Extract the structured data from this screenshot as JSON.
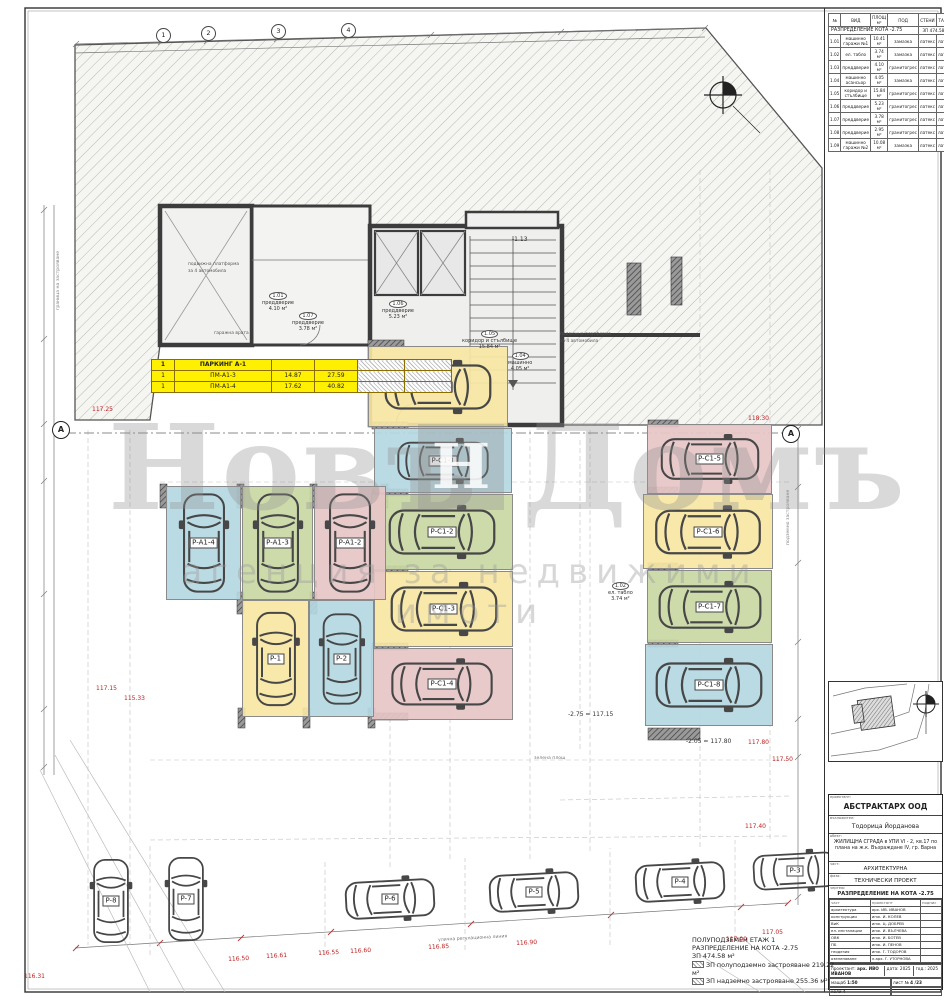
{
  "schedule": {
    "columns": [
      "№",
      "ВИД",
      "ПЛОЩ м²",
      "ПОД",
      "СТЕНИ",
      "ТАВАН"
    ],
    "title": "РАЗПРЕДЕЛЕНИЕ КОТА -2.75",
    "area_note": "ЗП 474.58 м²",
    "rows": [
      [
        "1.01",
        "машинно гаражи №1",
        "10.41 м²",
        "замазка",
        "латекс",
        "латекс"
      ],
      [
        "1.02",
        "ел. табло",
        "3.74 м²",
        "замазка",
        "латекс",
        "латекс"
      ],
      [
        "1.03",
        "преддверие",
        "4.10 м²",
        "гранитогрес",
        "латекс",
        "латекс"
      ],
      [
        "1.04",
        "машинно асансьор",
        "4.05 м²",
        "замазка",
        "латекс",
        "латекс"
      ],
      [
        "1.05",
        "коридор и стълбище",
        "15.84 м²",
        "гранитогрес",
        "латекс",
        "латекс"
      ],
      [
        "1.06",
        "преддверие",
        "5.23 м²",
        "гранитогрес",
        "латекс",
        "латекс"
      ],
      [
        "1.07",
        "преддверие",
        "3.78 м²",
        "гранитогрес",
        "латекс",
        "латекс"
      ],
      [
        "1.08",
        "преддверие",
        "2.95 м²",
        "гранитогрес",
        "латекс",
        "латекс"
      ],
      [
        "1.09",
        "машинно гаражи №2",
        "10.08 м²",
        "замазка",
        "латекс",
        "латекс"
      ]
    ]
  },
  "garage_table": {
    "header": [
      "1",
      "ПАРКИНГ А-1",
      "",
      ""
    ],
    "rows": [
      [
        "1",
        "ПМ-А1-3",
        "14.87",
        "27.59"
      ],
      [
        "1",
        "ПМ-А1-4",
        "17.62",
        "40.82"
      ]
    ]
  },
  "plan": {
    "spots": [
      {
        "label": "P-A1-1",
        "color": "yellow",
        "x": 368,
        "y": 346,
        "w": 138,
        "h": 79,
        "o": "h"
      },
      {
        "label": "P-C1-1",
        "color": "blue",
        "x": 374,
        "y": 428,
        "w": 136,
        "h": 63,
        "o": "h"
      },
      {
        "label": "P-C1-2",
        "color": "green",
        "x": 371,
        "y": 494,
        "w": 140,
        "h": 74,
        "o": "h"
      },
      {
        "label": "P-C1-3",
        "color": "yellow",
        "x": 374,
        "y": 571,
        "w": 137,
        "h": 74,
        "o": "h"
      },
      {
        "label": "P-C1-4",
        "color": "pink",
        "x": 371,
        "y": 648,
        "w": 140,
        "h": 70,
        "o": "h"
      },
      {
        "label": "P-C1-5",
        "color": "pink",
        "x": 647,
        "y": 424,
        "w": 123,
        "h": 68,
        "o": "h"
      },
      {
        "label": "P-C1-6",
        "color": "yellow",
        "x": 643,
        "y": 494,
        "w": 128,
        "h": 73,
        "o": "h"
      },
      {
        "label": "P-C1-7",
        "color": "green",
        "x": 647,
        "y": 570,
        "w": 123,
        "h": 71,
        "o": "h"
      },
      {
        "label": "P-C1-8",
        "color": "blue",
        "x": 645,
        "y": 644,
        "w": 126,
        "h": 80,
        "o": "h"
      },
      {
        "label": "P-A1-4",
        "color": "blue",
        "x": 166,
        "y": 486,
        "w": 73,
        "h": 112,
        "o": "v"
      },
      {
        "label": "P-A1-3",
        "color": "green",
        "x": 242,
        "y": 486,
        "w": 69,
        "h": 112,
        "o": "v"
      },
      {
        "label": "P-A1-2",
        "color": "pink",
        "x": 314,
        "y": 486,
        "w": 70,
        "h": 112,
        "o": "v"
      },
      {
        "label": "P-1",
        "color": "yellow",
        "x": 242,
        "y": 600,
        "w": 65,
        "h": 115,
        "o": "v"
      },
      {
        "label": "P-2",
        "color": "blue",
        "x": 309,
        "y": 600,
        "w": 63,
        "h": 115,
        "o": "v"
      },
      {
        "label": "P-8",
        "color": "none",
        "x": 82,
        "y": 846,
        "w": 58,
        "h": 110,
        "o": "v"
      },
      {
        "label": "P-7",
        "color": "none",
        "x": 157,
        "y": 843,
        "w": 58,
        "h": 112,
        "o": "v"
      },
      {
        "label": "P-6",
        "color": "none",
        "x": 327,
        "y": 868,
        "w": 126,
        "h": 62,
        "o": "h",
        "rot": -3
      },
      {
        "label": "P-5",
        "color": "none",
        "x": 471,
        "y": 861,
        "w": 126,
        "h": 62,
        "o": "h",
        "rot": -3
      },
      {
        "label": "P-4",
        "color": "none",
        "x": 617,
        "y": 851,
        "w": 126,
        "h": 62,
        "o": "h",
        "rot": -3
      },
      {
        "label": "P-3",
        "color": "none",
        "x": 737,
        "y": 842,
        "w": 116,
        "h": 58,
        "o": "h",
        "rot": -3
      }
    ],
    "room_labels": [
      {
        "num": "1.06",
        "name": "преддверие",
        "area": "5.23 м²",
        "x": 382,
        "y": 300
      },
      {
        "num": "1.05",
        "name": "коридор и стълбище",
        "area": "15.84 м²",
        "x": 462,
        "y": 330
      },
      {
        "num": "1.04",
        "name": "машинно",
        "area": "4.05 м²",
        "x": 508,
        "y": 352
      },
      {
        "num": "1.07",
        "name": "преддверие",
        "area": "3.78 м²",
        "x": 292,
        "y": 312
      },
      {
        "num": "1.01",
        "name": "преддверие",
        "area": "4.10 м²",
        "x": 262,
        "y": 292
      },
      {
        "num": "1.02",
        "name": "ел. табло",
        "area": "3.74 м²",
        "x": 608,
        "y": 582
      }
    ],
    "annotations": [
      {
        "text": "117.25",
        "x": 92,
        "y": 407,
        "color": "#b22"
      },
      {
        "text": "118.30",
        "x": 748,
        "y": 416,
        "color": "#b22"
      },
      {
        "text": "117.15",
        "x": 96,
        "y": 686,
        "color": "#b22"
      },
      {
        "text": "115.33",
        "x": 124,
        "y": 696,
        "color": "#b22"
      },
      {
        "text": "117.50",
        "x": 772,
        "y": 757,
        "color": "#b22"
      },
      {
        "text": "117.40",
        "x": 745,
        "y": 824,
        "color": "#b22"
      },
      {
        "text": "117.80",
        "x": 748,
        "y": 740,
        "color": "#b22"
      },
      {
        "text": "117.00",
        "x": 726,
        "y": 937,
        "color": "#b22"
      },
      {
        "text": "117.05",
        "x": 762,
        "y": 930,
        "color": "#b22"
      },
      {
        "text": "116.31",
        "x": 24,
        "y": 974,
        "color": "#b22"
      },
      {
        "text": "116.50",
        "x": 228,
        "y": 957,
        "color": "#b22",
        "rot": -3
      },
      {
        "text": "116.61",
        "x": 266,
        "y": 954,
        "color": "#b22",
        "rot": -3
      },
      {
        "text": "116.55",
        "x": 318,
        "y": 951,
        "color": "#b22",
        "rot": -3
      },
      {
        "text": "116.60",
        "x": 350,
        "y": 949,
        "color": "#b22",
        "rot": -3
      },
      {
        "text": "116.85",
        "x": 428,
        "y": 945,
        "color": "#b22",
        "rot": -3
      },
      {
        "text": "116.90",
        "x": 516,
        "y": 941,
        "color": "#b22",
        "rot": -3
      },
      {
        "text": "-2.75 = 117.15",
        "x": 568,
        "y": 712,
        "color": "#333"
      },
      {
        "text": "-2.05 = 117.80",
        "x": 686,
        "y": 739,
        "color": "#333"
      },
      {
        "text": "-1.13",
        "x": 512,
        "y": 237,
        "color": "#333"
      },
      {
        "text": "улична регулационна линия",
        "x": 438,
        "y": 938,
        "color": "#777",
        "fs": 4.6,
        "rot": -3
      },
      {
        "text": "зелена площ",
        "x": 534,
        "y": 756,
        "color": "#777",
        "fs": 4.6
      },
      {
        "text": "подвижна платформа\nза 4 автомобила",
        "x": 188,
        "y": 262,
        "color": "#555",
        "fs": 4.4
      },
      {
        "text": "подвижна платформа\nза 4 автомобила",
        "x": 560,
        "y": 332,
        "color": "#555",
        "fs": 4.4
      },
      {
        "text": "гаражна врата",
        "x": 214,
        "y": 331,
        "color": "#555",
        "fs": 4.4
      },
      {
        "text": "граница на застрояване",
        "x": 56,
        "y": 310,
        "color": "#888",
        "fs": 4.6,
        "rot": -90
      },
      {
        "text": "подземно застрояване",
        "x": 786,
        "y": 545,
        "color": "#888",
        "fs": 4.6,
        "rot": -90
      }
    ],
    "axis_bubbles": [
      {
        "n": "1",
        "x": 156,
        "y": 28
      },
      {
        "n": "2",
        "x": 201,
        "y": 26
      },
      {
        "n": "3",
        "x": 271,
        "y": 24
      },
      {
        "n": "4",
        "x": 341,
        "y": 23
      }
    ],
    "section_marks": [
      {
        "label": "А",
        "x": 52,
        "y": 421
      },
      {
        "label": "А",
        "x": 782,
        "y": 425
      }
    ]
  },
  "watermark": {
    "left": "Новъ",
    "right": "Домъ",
    "logo": "Н",
    "subtitle": "агенция за недвижими имоти"
  },
  "note_block": {
    "line1": "ПОЛУПОДЗЕМЕН ЕТАЖ 1",
    "line2": "РАЗПРЕДЕЛЕНИЕ НА КОТА -2.75",
    "line3": "ЗП 474.58 м²",
    "line4": "ЗП полуподземно застрояване 219.22 м²",
    "line5": "ЗП надземно застрояване 255.36 м²"
  },
  "title_block": {
    "company_label": "проектант:",
    "company": "АБСТРАКТАРХ ООД",
    "client_label": "възложител:",
    "client": "Тодорица Йорданова",
    "object_label": "обект:",
    "object": "ЖИЛИЩНА СГРАДА в УПИ VI - 2, кв.17 по плана на ж.к. Възраждане IV, гр. Варна",
    "part_label": "част:",
    "part": "АРХИТЕКТУРНА",
    "phase_label": "фаза:",
    "phase": "ТЕХНИЧЕСКИ ПРОЕКТ",
    "drawing_label": "чертеж:",
    "drawing": "РАЗПРЕДЕЛЕНИЕ НА КОТА -2.75",
    "sign_columns": [
      "част",
      "проектант",
      "подпис"
    ],
    "signatures": [
      [
        "архитектура",
        "арх. ИВ. ИВАНОВ"
      ],
      [
        "конструкции",
        "инж. И. КОЛЕВ"
      ],
      [
        "ВиК",
        "инж. Ц. ДОБРЕВ"
      ],
      [
        "ел. инсталации",
        "инж. И. ВЪЛЧЕВА"
      ],
      [
        "ОВК",
        "инж. И. БОТЕВ"
      ],
      [
        "ПБ",
        "инж. И. ПЕНОВ"
      ],
      [
        "геодезия",
        "инж. Г. ТОДОРОВ"
      ],
      [
        "озеленяване",
        "л.арх. Г. УТОРНОВА"
      ]
    ],
    "author_label": "проектант:",
    "author": "арх. ИВО ИВАНОВ",
    "date_label": "дата:",
    "date": "2025",
    "year_label": "год.:",
    "year": "2025",
    "scale_label": "мащаб",
    "scale": "1:50",
    "sheet_label": "лист №",
    "sheet": "4 /23",
    "copy_label": "коли",
    "copy": "4"
  }
}
